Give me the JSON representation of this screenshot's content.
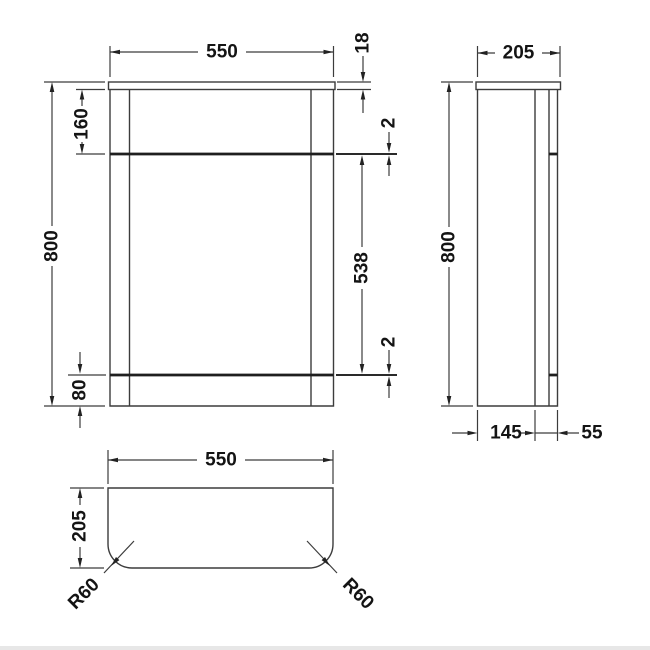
{
  "front_view": {
    "width": "550",
    "top_panel_thickness": "18",
    "top_section_height": "160",
    "overall_height": "800",
    "upper_gap": "2",
    "middle_section_height": "538",
    "lower_gap": "2",
    "base_height": "80"
  },
  "side_view": {
    "depth": "205",
    "overall_height": "800",
    "back_depth": "145",
    "front_depth": "55"
  },
  "plan_view": {
    "width": "550",
    "depth": "205",
    "corner_radius_left": "R60",
    "corner_radius_right": "R60"
  },
  "colors": {
    "background": "#ffffff",
    "line": "#3c3c3c",
    "thick_line": "#1f1f1f",
    "text": "#141414",
    "bottom_edge": "#e7e7e7"
  }
}
